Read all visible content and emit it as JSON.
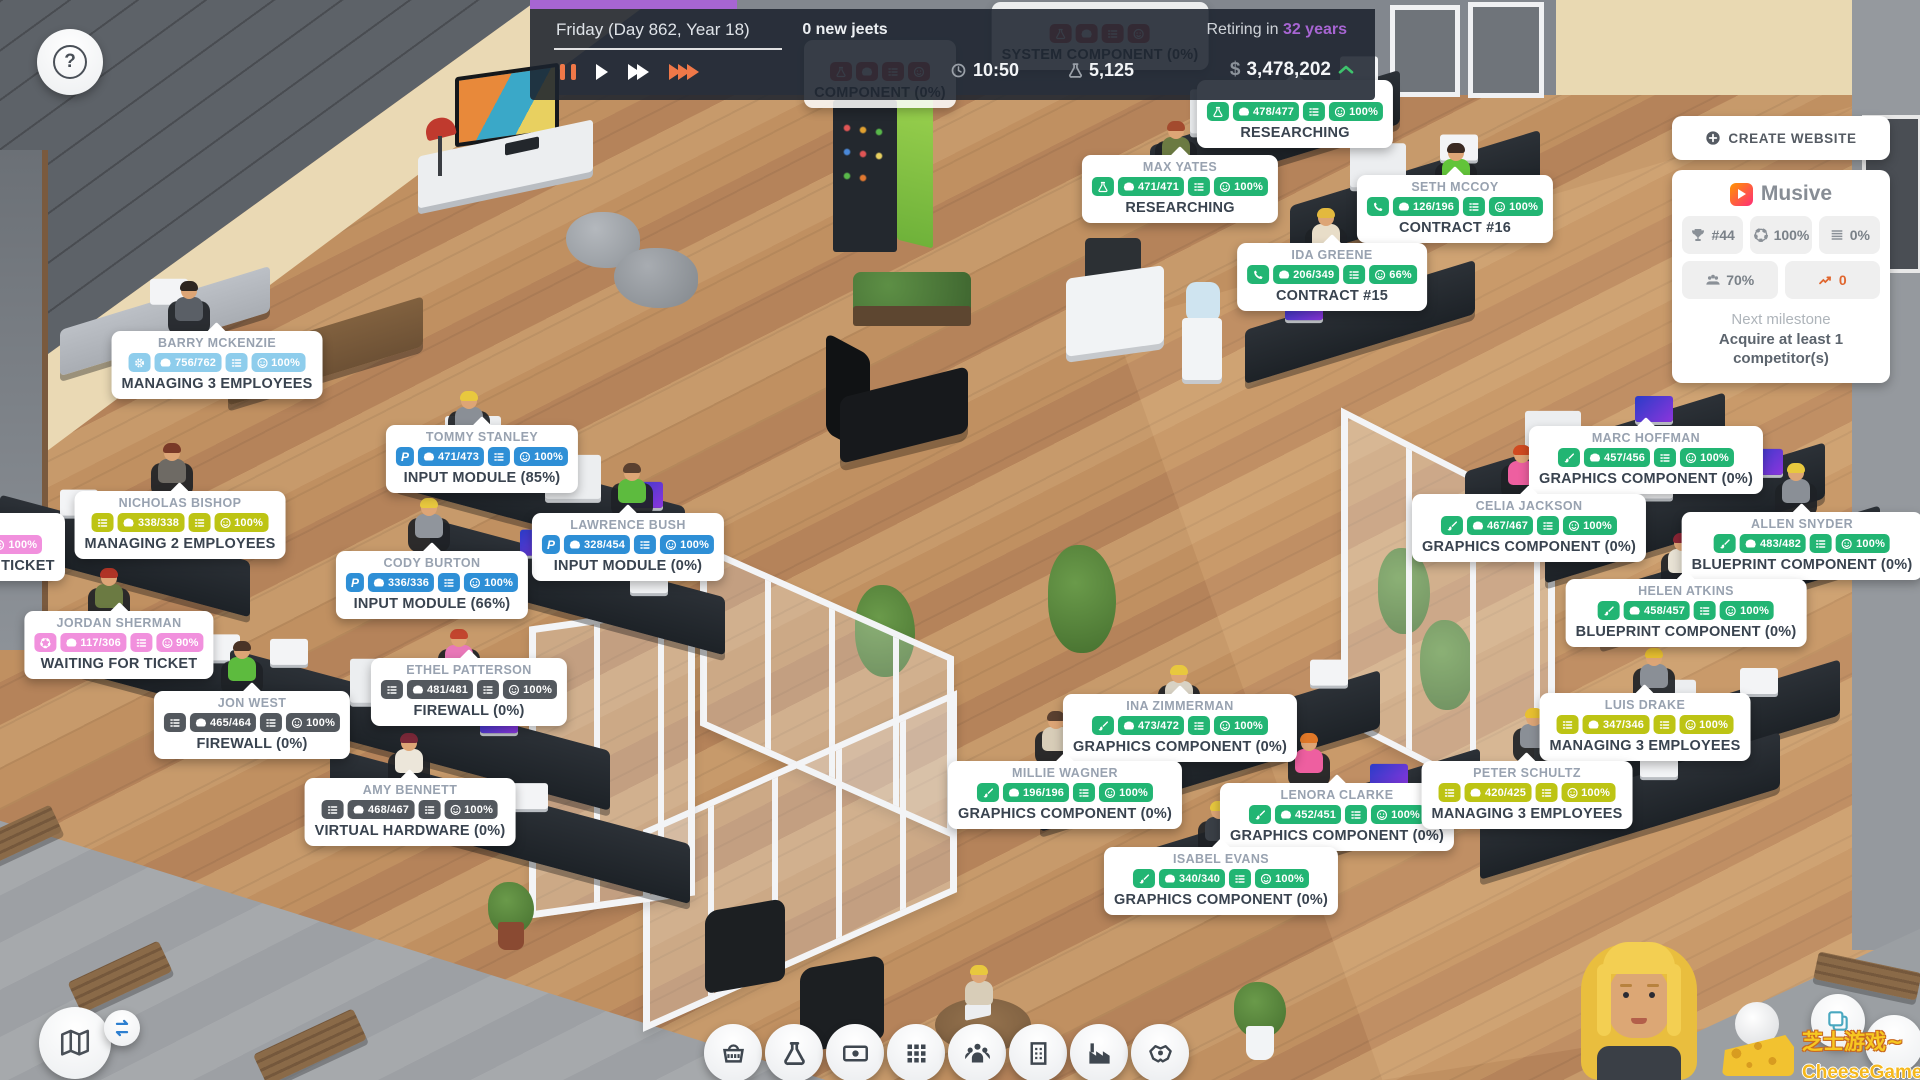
{
  "top_bar": {
    "date": "Friday (Day 862, Year 18)",
    "jeets": "0 new jeets",
    "retiring_prefix": "Retiring in",
    "retiring_value": "32 years",
    "time": "10:50",
    "research_points": "5,125",
    "currency": "$",
    "balance": "3,478,202",
    "progress_color": "#a765d2"
  },
  "website_panel": {
    "create_button": "CREATE WEBSITE",
    "site_name": "Musive",
    "stats": [
      {
        "icon": "trophy",
        "value": "#44"
      },
      {
        "icon": "life",
        "value": "100%"
      },
      {
        "icon": "stack",
        "value": "0%"
      },
      {
        "icon": "users",
        "value": "70%",
        "wide": true
      },
      {
        "icon": "trend",
        "value": "0",
        "wide": true,
        "accent": true
      }
    ],
    "milestone_label": "Next milestone",
    "milestone_text": "Acquire at least 1 competitor(s)"
  },
  "badge_colors": {
    "green": "#22b573",
    "blue": "#2e8fd6",
    "dark": "#53585e",
    "yellow": "#bdc414",
    "lightblue": "#8ecdec",
    "pink": "#f190dd",
    "red": "#e05555"
  },
  "employees": [
    {
      "name": "",
      "role": "flask",
      "color": "green",
      "speed": "478/477",
      "mood": "100%",
      "task": "RESEARCHING",
      "x": 1295,
      "y": 80
    },
    {
      "name": "MAX YATES",
      "role": "flask",
      "color": "green",
      "speed": "471/471",
      "mood": "100%",
      "task": "RESEARCHING",
      "x": 1180,
      "y": 155
    },
    {
      "name": "SETH MCCOY",
      "role": "phone",
      "color": "green",
      "speed": "126/196",
      "mood": "100%",
      "task": "CONTRACT #16",
      "x": 1455,
      "y": 175
    },
    {
      "name": "IDA GREENE",
      "role": "phone",
      "color": "green",
      "speed": "206/349",
      "mood": "66%",
      "task": "CONTRACT #15",
      "x": 1332,
      "y": 243
    },
    {
      "name": "BARRY MCKENZIE",
      "role": "gear",
      "color": "lightblue",
      "speed": "756/762",
      "mood": "100%",
      "task": "MANAGING 3 EMPLOYEES",
      "x": 217,
      "y": 331
    },
    {
      "name": "NICHOLAS BISHOP",
      "role": "list",
      "color": "yellow",
      "speed": "338/338",
      "mood": "100%",
      "task": "MANAGING 2 EMPLOYEES",
      "x": 180,
      "y": 491
    },
    {
      "name": "JORDAN SHERMAN",
      "role": "life",
      "color": "pink",
      "speed": "117/306",
      "mood": "90%",
      "task": "WAITING FOR TICKET",
      "x": 119,
      "y": 611
    },
    {
      "name": "",
      "role": "life",
      "color": "pink",
      "speed": "",
      "mood": "100%",
      "task": "WAITING FOR TICKET",
      "x": -112,
      "y": 513,
      "align": "left"
    },
    {
      "name": "TOMMY STANLEY",
      "role": "dev",
      "color": "blue",
      "speed": "471/473",
      "mood": "100%",
      "task": "INPUT MODULE (85%)",
      "x": 482,
      "y": 425
    },
    {
      "name": "LAWRENCE BUSH",
      "role": "dev",
      "color": "blue",
      "speed": "328/454",
      "mood": "100%",
      "task": "INPUT MODULE (0%)",
      "x": 628,
      "y": 513
    },
    {
      "name": "CODY BURTON",
      "role": "dev",
      "color": "blue",
      "speed": "336/336",
      "mood": "100%",
      "task": "INPUT MODULE (66%)",
      "x": 432,
      "y": 551
    },
    {
      "name": "JON WEST",
      "role": "list",
      "color": "dark",
      "speed": "465/464",
      "mood": "100%",
      "task": "FIREWALL (0%)",
      "x": 252,
      "y": 691
    },
    {
      "name": "ETHEL PATTERSON",
      "role": "list",
      "color": "dark",
      "speed": "481/481",
      "mood": "100%",
      "task": "FIREWALL (0%)",
      "x": 469,
      "y": 658
    },
    {
      "name": "AMY BENNETT",
      "role": "list",
      "color": "dark",
      "speed": "468/467",
      "mood": "100%",
      "task": "VIRTUAL HARDWARE (0%)",
      "x": 410,
      "y": 778
    },
    {
      "name": "MARC HOFFMAN",
      "role": "brush",
      "color": "green",
      "speed": "457/456",
      "mood": "100%",
      "task": "GRAPHICS COMPONENT (0%)",
      "x": 1646,
      "y": 426
    },
    {
      "name": "CELIA JACKSON",
      "role": "brush",
      "color": "green",
      "speed": "467/467",
      "mood": "100%",
      "task": "GRAPHICS COMPONENT (0%)",
      "x": 1529,
      "y": 494
    },
    {
      "name": "ALLEN SNYDER",
      "role": "brush",
      "color": "green",
      "speed": "483/482",
      "mood": "100%",
      "task": "BLUEPRINT COMPONENT (0%)",
      "x": 1802,
      "y": 512
    },
    {
      "name": "HELEN ATKINS",
      "role": "brush",
      "color": "green",
      "speed": "458/457",
      "mood": "100%",
      "task": "BLUEPRINT COMPONENT (0%)",
      "x": 1686,
      "y": 579
    },
    {
      "name": "INA ZIMMERMAN",
      "role": "brush",
      "color": "green",
      "speed": "473/472",
      "mood": "100%",
      "task": "GRAPHICS COMPONENT (0%)",
      "x": 1180,
      "y": 694
    },
    {
      "name": "MILLIE WAGNER",
      "role": "brush",
      "color": "green",
      "speed": "196/196",
      "mood": "100%",
      "task": "GRAPHICS COMPONENT (0%)",
      "x": 1065,
      "y": 761
    },
    {
      "name": "LENORA CLARKE",
      "role": "brush",
      "color": "green",
      "speed": "452/451",
      "mood": "100%",
      "task": "GRAPHICS COMPONENT (0%)",
      "x": 1337,
      "y": 783
    },
    {
      "name": "ISABEL EVANS",
      "role": "brush",
      "color": "green",
      "speed": "340/340",
      "mood": "100%",
      "task": "GRAPHICS COMPONENT (0%)",
      "x": 1221,
      "y": 847
    },
    {
      "name": "LUIS DRAKE",
      "role": "list",
      "color": "yellow",
      "speed": "347/346",
      "mood": "100%",
      "task": "MANAGING 3 EMPLOYEES",
      "x": 1645,
      "y": 693
    },
    {
      "name": "PETER SCHULTZ",
      "role": "list",
      "color": "yellow",
      "speed": "420/425",
      "mood": "100%",
      "task": "MANAGING 3 EMPLOYEES",
      "x": 1527,
      "y": 761
    },
    {
      "name": "",
      "role": "flask",
      "color": "red",
      "speed": "",
      "mood": "",
      "task": "SYSTEM COMPONENT (0%)",
      "x": 1100,
      "y": 2,
      "dim": true
    },
    {
      "name": "",
      "role": "flask",
      "color": "red",
      "speed": "",
      "mood": "",
      "task": "COMPONENT (0%)",
      "x": 880,
      "y": 40,
      "dim": true
    }
  ],
  "toolbar": {
    "buttons": [
      {
        "name": "shop",
        "icon": "basket"
      },
      {
        "name": "research",
        "icon": "flask"
      },
      {
        "name": "finances",
        "icon": "money"
      },
      {
        "name": "features",
        "icon": "grid"
      },
      {
        "name": "team",
        "icon": "team"
      },
      {
        "name": "building",
        "icon": "building"
      },
      {
        "name": "production",
        "icon": "factory"
      },
      {
        "name": "contracts",
        "icon": "hand"
      }
    ]
  },
  "corner": {
    "help": "?"
  },
  "watermark": {
    "line1": "芝士游戏~",
    "line2": "CheeseGame.org"
  }
}
